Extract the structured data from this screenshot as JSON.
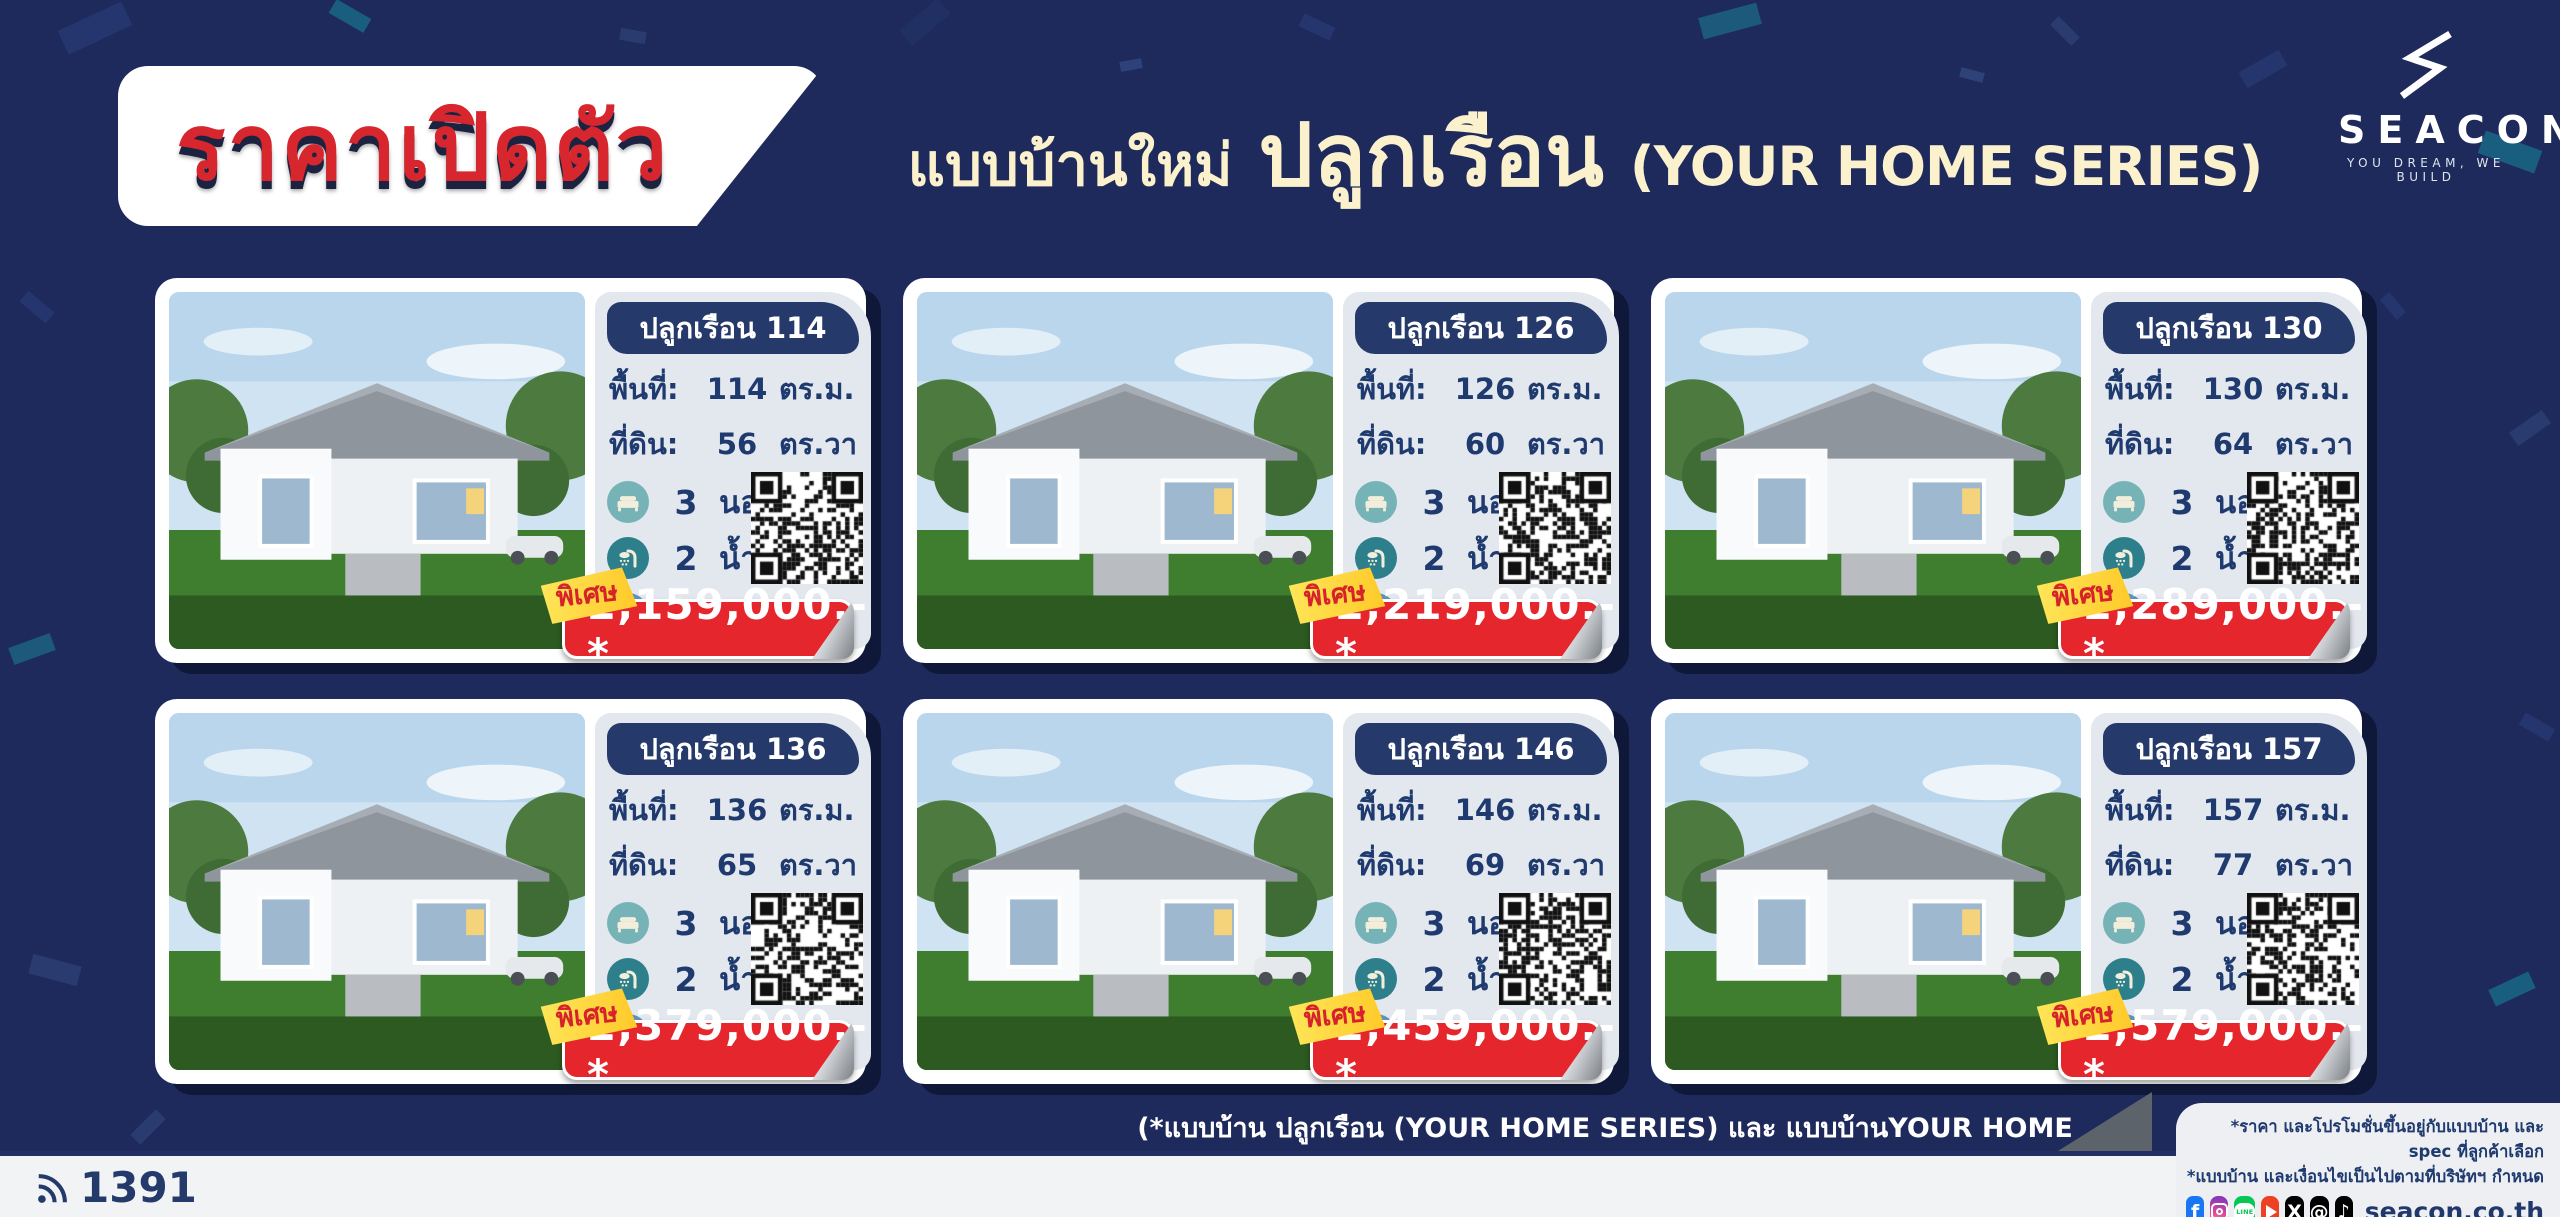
{
  "header": {
    "launch_badge": "ราคาเปิดตัว",
    "title_prefix": "แบบบ้านใหม่",
    "title_main": "ปลูกเรือน",
    "title_suffix": "(YOUR HOME SERIES)",
    "logo": {
      "name": "SEACON",
      "mark": "Ⓗ",
      "tagline": "YOU DREAM, WE BUILD"
    }
  },
  "labels": {
    "area": "พื้นที่:",
    "land": "ที่ดิน:",
    "sqm": "ตร.ม.",
    "sqwa": "ตร.วา",
    "bed_unit": "นอน",
    "bath_unit": "น้ำ",
    "car_unit": "คัน",
    "special": "พิเศษ"
  },
  "cards": [
    {
      "name": "ปลูกเรือน 114",
      "area": "114",
      "land": "56",
      "beds": "3",
      "baths": "2",
      "cars": "–",
      "price": "2,159,000.-*"
    },
    {
      "name": "ปลูกเรือน 126",
      "area": "126",
      "land": "60",
      "beds": "3",
      "baths": "2",
      "cars": "2",
      "price": "2,219,000.-*"
    },
    {
      "name": "ปลูกเรือน 130",
      "area": "130",
      "land": "64",
      "beds": "3",
      "baths": "2",
      "cars": "–",
      "price": "2,289,000.-*"
    },
    {
      "name": "ปลูกเรือน 136",
      "area": "136",
      "land": "65",
      "beds": "3",
      "baths": "2",
      "cars": "–",
      "price": "2,379,000.-*"
    },
    {
      "name": "ปลูกเรือน 146",
      "area": "146",
      "land": "69",
      "beds": "3",
      "baths": "2",
      "cars": "2",
      "price": "2,459,000.-*"
    },
    {
      "name": "ปลูกเรือน 157",
      "area": "157",
      "land": "77",
      "beds": "3",
      "baths": "2",
      "cars": "2",
      "price": "2,579,000.-*"
    }
  ],
  "footer": {
    "disclaimer": "(*แบบบ้าน ปลูกเรือน (YOUR HOME SERIES) และ แบบบ้านYOUR HOME 1, 2 ไม่ร่วมกับโปรโมชั่นต่างๆ ของทางบริษัทฯ)",
    "hotline": "1391",
    "fine_print_1": "*ราคา และโปรโมชั่นขึ้นอยู่กับแบบบ้าน และ spec ที่ลูกค้าเลือก",
    "fine_print_2": "*แบบบ้าน และเงื่อนไขเป็นไปตามที่บริษัทฯ กำหนด",
    "website": "seacon.co.th",
    "social_glyphs": {
      "facebook": "f",
      "x": "X",
      "threads": "@",
      "tiktok": "♪",
      "line": "LINE"
    }
  },
  "colors": {
    "background_navy": "#1f2a5c",
    "badge_navy": "#26396b",
    "text_navy": "#1e3a6e",
    "accent_red": "#e5262d",
    "launch_red": "#d7262d",
    "special_yellow": "#ffd43c",
    "title_cream": "#fbf2cd",
    "panel_gray": "#e3e7ee",
    "bed_teal": "#76b3b6",
    "shower_teal": "#2d7f8c",
    "car_blue": "#5e93bb"
  }
}
